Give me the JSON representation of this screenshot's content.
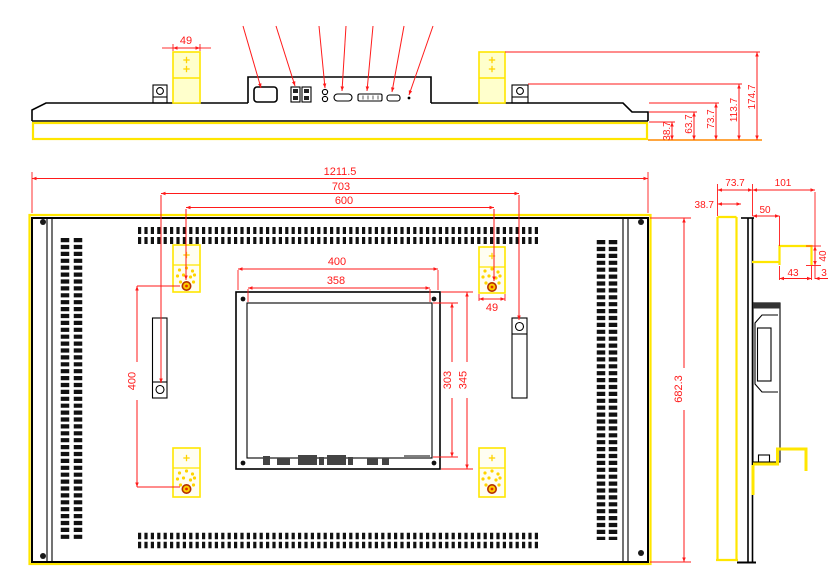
{
  "drawing": {
    "kind": "technical-drawing",
    "views": [
      "top-view",
      "rear-view",
      "side-view"
    ],
    "colors": {
      "geometry": "#000000",
      "highlight": "#ffe600",
      "dimension": "#ff1a1a",
      "baseline": "#ff8800",
      "pad_fill": "#ffffcc"
    },
    "top_view": {
      "pad_width": "49",
      "height_dims": {
        "d1": "38.7",
        "d2": "63.7",
        "d3": "73.7",
        "d4": "113.7",
        "d5": "174.7"
      },
      "ports": [
        "power-inlet",
        "usb-ports",
        "audio-jacks",
        "vga-port",
        "dvi-port",
        "hdmi-port",
        "power-button"
      ]
    },
    "rear_view": {
      "overall_width": "1211.5",
      "handle_spacing": "703",
      "mount_width": "600",
      "plate_width": "400",
      "opening_width": "358",
      "opening_height": "303",
      "plate_height": "345",
      "pad_width": "49",
      "mount_height": "400",
      "overall_height": "682.3"
    },
    "side_view": {
      "front_depth": "73.7",
      "rear_depth": "101",
      "bezel_depth": "38.7",
      "box_depth": "50",
      "bracket_height": "40",
      "bracket_width": "43",
      "bracket_gap": "3"
    }
  }
}
